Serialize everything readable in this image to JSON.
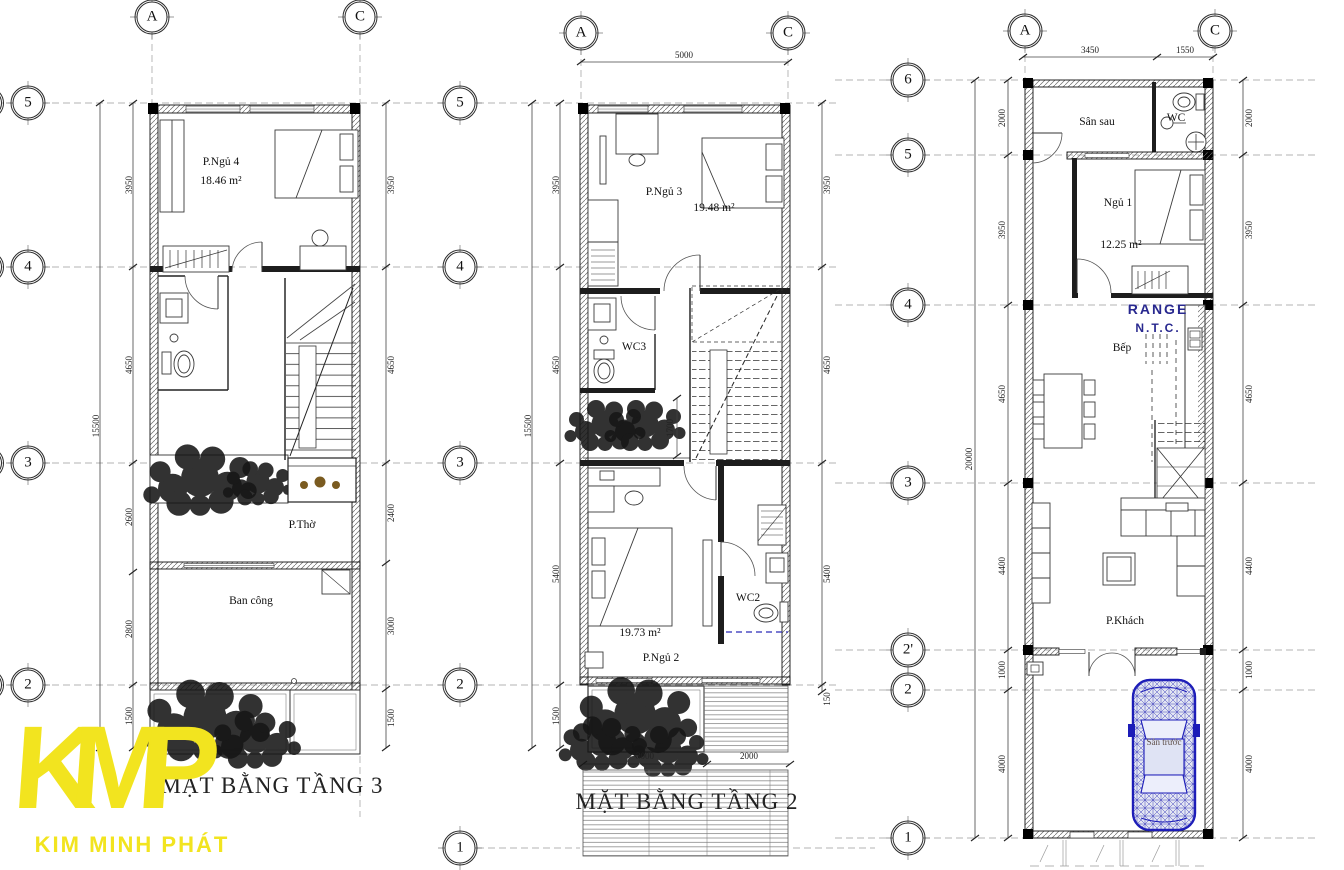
{
  "colors": {
    "car_blue": "#1c1cb8",
    "note_navy": "#28288f",
    "logo_yellow": "#f2e41f"
  },
  "logo": {
    "monogram": "KMP",
    "name": "KIM MINH PHÁT"
  },
  "floor3": {
    "title": "MẶT BẰNG TẦNG 3",
    "cols": [
      "A",
      "C"
    ],
    "rows": [
      "5",
      "4",
      "3",
      "2"
    ],
    "total_left": "15500",
    "dims_left": [
      "3950",
      "4650",
      "2600",
      "2800",
      "1500"
    ],
    "dims_right": [
      "3950",
      "4650",
      "2400",
      "3000",
      "1500"
    ],
    "rooms": {
      "bedroom4": "P.Ngủ 4",
      "bedroom4_area": "18.46 m²",
      "altar": "P.Thờ",
      "balcony": "Ban công"
    }
  },
  "floor2": {
    "title": "MẶT BẰNG TẦNG 2",
    "cols": [
      "A",
      "C"
    ],
    "rows": [
      "5",
      "4",
      "3",
      "2",
      "1"
    ],
    "dim_top": "5000",
    "total_left": "15500",
    "dims_left": [
      "3950",
      "4650",
      "5400",
      "1500"
    ],
    "dims_right": [
      "3950",
      "4650",
      "5400",
      "150"
    ],
    "dims_bottom": [
      "3000",
      "2000"
    ],
    "dim_void": "1700",
    "rooms": {
      "bedroom3": "P.Ngủ 3",
      "bedroom3_area": "19.48 m²",
      "wc3": "WC3",
      "bedroom2": "P.Ngủ 2",
      "bedroom2_area": "19.73 m²",
      "wc2": "WC2"
    }
  },
  "floor1": {
    "cols": [
      "A",
      "C"
    ],
    "rows": [
      "6",
      "5",
      "4",
      "3",
      "2'",
      "2",
      "1"
    ],
    "dims_top": [
      "3450",
      "1550"
    ],
    "total_left": "20000",
    "dims_left": [
      "2000",
      "3950",
      "4650",
      "4400",
      "1000",
      "4000"
    ],
    "dims_right": [
      "2000",
      "3950",
      "4650",
      "4400",
      "1000",
      "4000"
    ],
    "rooms": {
      "backyard": "Sân sau",
      "wc": "WC",
      "bedroom1": "Ngủ 1",
      "bedroom1_area": "12.25 m²",
      "kitchen": "Bếp",
      "living": "P.Khách",
      "frontyard": "Sân trước"
    },
    "note_line1": "RANGE",
    "note_line2": "N.T.C."
  }
}
